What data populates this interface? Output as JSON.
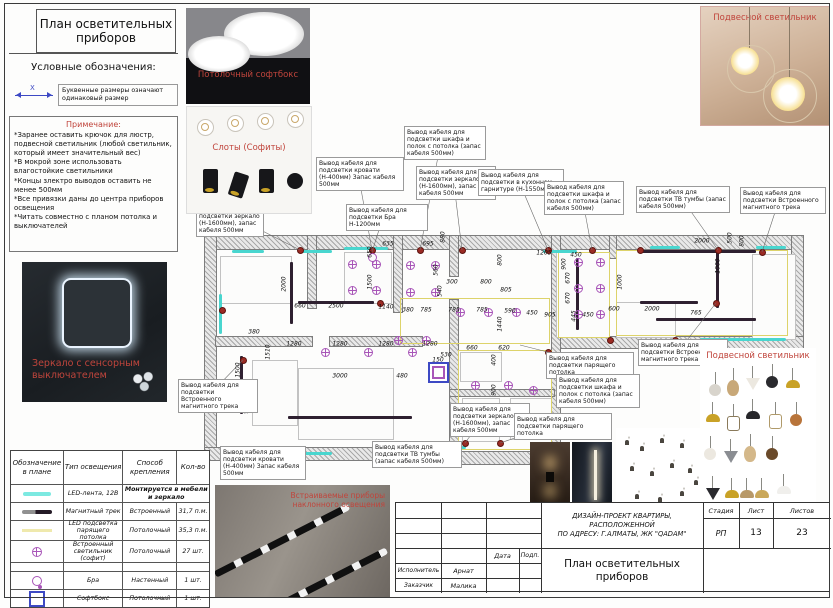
{
  "panel": {
    "title": "План осветительных приборов",
    "legend_header": "Условные обозначения:",
    "symbol_x": "X",
    "dim_note": "Буквенные размеры означают одинаковый размер",
    "notes_header": "Примечание:",
    "notes": [
      "*Заранее оставить крючок для люстр, подвесной светильник (любой светильник, который имеет значительный вес)",
      "*В мокрой зоне использовать влагостойкие светильники",
      "*Концы злектро выводов оставить не менее 500мм",
      "*Все привязки даны до центра приборов освещения",
      "*Читать совместно с планом потолка и выключателей"
    ],
    "mirror_caption": "Зеркало с сенсорным выключателем"
  },
  "photos": {
    "softbox_caption": "Потолочный софтбокс",
    "slots_caption": "Слоты (Софиты)",
    "pendant_top_caption": "Подвесной светильник",
    "pendant_collage_caption": "Подвесной светильник",
    "track_caption": "Встраиваемые приборы наклонного освещения"
  },
  "table": {
    "headers": [
      "Обозначение в плане",
      "Тип освещения",
      "Способ крепления",
      "Кол-во"
    ],
    "row_heights": [
      33,
      17,
      17,
      19,
      21,
      8,
      17,
      17
    ],
    "rows": [
      {
        "sym": "",
        "type": "",
        "mount": "",
        "qty": "",
        "header": true
      },
      {
        "sym": "led",
        "type": "LED-лента, 12В",
        "mount": "Монтируется в мебели и зеркало",
        "qty": "",
        "span": true
      },
      {
        "sym": "track",
        "type": "Магнитный трек",
        "mount": "Встроенный",
        "qty": "31,7 п.м."
      },
      {
        "sym": "ledceil",
        "type": "LED подсветка парящего потолка",
        "mount": "Потолочный",
        "qty": "35,3 п.м."
      },
      {
        "sym": "spot",
        "type": "Встроенный светильник (софит)",
        "mount": "Потолочный",
        "qty": "27 шт."
      },
      {
        "sym": "",
        "type": "",
        "mount": "",
        "qty": ""
      },
      {
        "sym": "bra",
        "type": "Бра",
        "mount": "Настенный",
        "qty": "1 шт."
      },
      {
        "sym": "softbox",
        "type": "Софтбокс",
        "mount": "Потолочный",
        "qty": "1 шт."
      }
    ]
  },
  "titleblock": {
    "project_lines": [
      "ДИЗАЙН-ПРОЕКТ КВАРТИРЫ,",
      "РАСПОЛОЖЕННОЙ",
      "ПО АДРЕСУ: Г.АЛМАТЫ, ЖК \"QADAM\""
    ],
    "sheet_title": "План осветительных приборов",
    "stage_label": "Стадия",
    "stage_value": "РП",
    "sheet_label": "Лист",
    "sheet_value": "13",
    "sheets_label": "Листов",
    "sheets_value": "23",
    "date_label": "Дата",
    "sign_label": "Подп.",
    "executor_label": "Исполнитель",
    "executor_value": "Арнат",
    "client_label": "Заказчик",
    "client_value": "Малика"
  },
  "plan": {
    "walls": [
      [
        205,
        236,
        598,
        13
      ],
      [
        792,
        236,
        11,
        110
      ],
      [
        556,
        337,
        247,
        11
      ],
      [
        205,
        236,
        11,
        224
      ],
      [
        205,
        448,
        236,
        12
      ],
      [
        440,
        452,
        122,
        12
      ],
      [
        216,
        337,
        96,
        9
      ],
      [
        330,
        337,
        92,
        9
      ],
      [
        308,
        236,
        8,
        72
      ],
      [
        394,
        236,
        8,
        76
      ],
      [
        450,
        236,
        8,
        40
      ],
      [
        450,
        300,
        8,
        152
      ],
      [
        552,
        236,
        8,
        216
      ],
      [
        610,
        236,
        6,
        22
      ],
      [
        450,
        390,
        104,
        6
      ]
    ],
    "furniture": [
      [
        220,
        256,
        70,
        46
      ],
      [
        344,
        252,
        46,
        50
      ],
      [
        252,
        360,
        44,
        64
      ],
      [
        298,
        368,
        94,
        70
      ],
      [
        460,
        352,
        40,
        28
      ],
      [
        462,
        398,
        36,
        42
      ],
      [
        510,
        398,
        40,
        40
      ],
      [
        556,
        252,
        52,
        84
      ],
      [
        752,
        254,
        42,
        84
      ],
      [
        616,
        302,
        58,
        34
      ]
    ],
    "yellow": [
      [
        400,
        298,
        148,
        44
      ],
      [
        558,
        252,
        50,
        84
      ],
      [
        616,
        250,
        170,
        84
      ],
      [
        458,
        350,
        92,
        98
      ]
    ],
    "cyan": [
      [
        232,
        250,
        32,
        3
      ],
      [
        298,
        250,
        34,
        3
      ],
      [
        344,
        247,
        44,
        3
      ],
      [
        543,
        250,
        34,
        3
      ],
      [
        650,
        246,
        30,
        3
      ],
      [
        282,
        452,
        50,
        3
      ],
      [
        420,
        446,
        46,
        3
      ],
      [
        700,
        338,
        86,
        3
      ],
      [
        219,
        294,
        3,
        40
      ],
      [
        756,
        246,
        30,
        3
      ]
    ],
    "tracks": [
      [
        290,
        262,
        3,
        62
      ],
      [
        298,
        301,
        76,
        3
      ],
      [
        240,
        356,
        3,
        58
      ],
      [
        288,
        416,
        124,
        3
      ],
      [
        576,
        258,
        3,
        72
      ],
      [
        640,
        250,
        116,
        3
      ],
      [
        716,
        252,
        3,
        56
      ],
      [
        640,
        301,
        58,
        3
      ],
      [
        656,
        318,
        100,
        3
      ]
    ],
    "spots": [
      [
        352,
        264
      ],
      [
        376,
        264
      ],
      [
        352,
        290
      ],
      [
        376,
        290
      ],
      [
        410,
        265
      ],
      [
        435,
        265
      ],
      [
        410,
        292
      ],
      [
        435,
        292
      ],
      [
        460,
        312
      ],
      [
        488,
        312
      ],
      [
        516,
        312
      ],
      [
        398,
        340
      ],
      [
        426,
        340
      ],
      [
        325,
        352
      ],
      [
        368,
        352
      ],
      [
        412,
        352
      ],
      [
        475,
        385
      ],
      [
        508,
        385
      ],
      [
        475,
        413
      ],
      [
        508,
        413
      ],
      [
        533,
        390
      ],
      [
        578,
        262
      ],
      [
        578,
        288
      ],
      [
        578,
        314
      ],
      [
        600,
        262
      ],
      [
        600,
        288
      ],
      [
        600,
        314
      ]
    ],
    "outlets": [
      [
        300,
        250
      ],
      [
        372,
        250
      ],
      [
        420,
        250
      ],
      [
        462,
        250
      ],
      [
        548,
        250
      ],
      [
        592,
        250
      ],
      [
        640,
        250
      ],
      [
        718,
        250
      ],
      [
        762,
        252
      ],
      [
        302,
        454
      ],
      [
        425,
        448
      ],
      [
        465,
        443
      ],
      [
        500,
        443
      ],
      [
        548,
        352
      ],
      [
        610,
        340
      ],
      [
        675,
        340
      ],
      [
        222,
        310
      ],
      [
        243,
        360
      ],
      [
        380,
        303
      ],
      [
        716,
        303
      ]
    ],
    "bra_symbol": [
      372,
      257
    ],
    "softbox_symbol": [
      428,
      362,
      17,
      17
    ],
    "dims": [
      [
        "1400",
        358,
        227,
        0
      ],
      [
        "880",
        443,
        237,
        1
      ],
      [
        "635",
        388,
        244,
        0
      ],
      [
        "695",
        428,
        244,
        0
      ],
      [
        "650",
        370,
        252,
        1
      ],
      [
        "2000",
        284,
        284,
        1
      ],
      [
        "1500",
        370,
        282,
        1
      ],
      [
        "560",
        436,
        270,
        1
      ],
      [
        "540",
        440,
        291,
        1
      ],
      [
        "300",
        452,
        282,
        0
      ],
      [
        "800",
        486,
        282,
        0
      ],
      [
        "805",
        506,
        290,
        0
      ],
      [
        "800",
        500,
        260,
        1
      ],
      [
        "1205",
        544,
        253,
        0
      ],
      [
        "900",
        564,
        264,
        1
      ],
      [
        "450",
        576,
        255,
        0
      ],
      [
        "670",
        568,
        278,
        1
      ],
      [
        "670",
        568,
        298,
        1
      ],
      [
        "445",
        574,
        316,
        1
      ],
      [
        "905",
        550,
        315,
        0
      ],
      [
        "450",
        532,
        313,
        0
      ],
      [
        "450",
        588,
        315,
        0
      ],
      [
        "600",
        614,
        309,
        0
      ],
      [
        "2000",
        652,
        309,
        0
      ],
      [
        "765",
        696,
        313,
        0
      ],
      [
        "1000",
        620,
        282,
        1
      ],
      [
        "2000",
        702,
        241,
        0
      ],
      [
        "800",
        742,
        241,
        1
      ],
      [
        "500",
        730,
        238,
        1
      ],
      [
        "1000",
        718,
        266,
        1
      ],
      [
        "660",
        300,
        306,
        0
      ],
      [
        "2500",
        336,
        306,
        0
      ],
      [
        "1140",
        386,
        307,
        0
      ],
      [
        "380",
        408,
        310,
        0
      ],
      [
        "785",
        426,
        310,
        0
      ],
      [
        "785",
        454,
        310,
        0
      ],
      [
        "785",
        482,
        310,
        0
      ],
      [
        "590",
        510,
        311,
        0
      ],
      [
        "1440",
        500,
        324,
        1
      ],
      [
        "1280",
        294,
        344,
        0
      ],
      [
        "1280",
        340,
        344,
        0
      ],
      [
        "1280",
        386,
        344,
        0
      ],
      [
        "1280",
        430,
        344,
        0
      ],
      [
        "1510",
        268,
        352,
        1
      ],
      [
        "380",
        254,
        332,
        0
      ],
      [
        "1500",
        238,
        370,
        1
      ],
      [
        "3000",
        340,
        376,
        0
      ],
      [
        "480",
        402,
        376,
        0
      ],
      [
        "900",
        246,
        408,
        1
      ],
      [
        "150",
        438,
        360,
        0
      ],
      [
        "530",
        446,
        355,
        0
      ],
      [
        "660",
        472,
        348,
        0
      ],
      [
        "620",
        504,
        348,
        0
      ],
      [
        "400",
        494,
        360,
        1
      ],
      [
        "900",
        494,
        390,
        1
      ]
    ],
    "callouts": [
      {
        "t": "Вывод кабеля для подсветки зеркало (Н-1600мм), запас кабеля 500мм",
        "x": 196,
        "y": 203,
        "w": 62,
        "lx": 300,
        "ly": 250
      },
      {
        "t": "Вывод кабеля для подсветки кровати (Н-400мм) Запас кабеля 500мм",
        "x": 316,
        "y": 157,
        "w": 82,
        "lx": 372,
        "ly": 250
      },
      {
        "t": "Вывод кабеля для подсветки Бра Н-1200мм",
        "x": 346,
        "y": 204,
        "w": 76,
        "lx": 372,
        "ly": 252
      },
      {
        "t": "Вывод кабеля для подсветки шкафа и полок с потолка (запас кабеля 500мм)",
        "x": 404,
        "y": 126,
        "w": 76,
        "lx": 420,
        "ly": 250
      },
      {
        "t": "Вывод кабеля для подсветки зеркало (Н-1600мм), запас кабеля 500мм",
        "x": 416,
        "y": 166,
        "w": 74,
        "lx": 462,
        "ly": 250
      },
      {
        "t": "Вывод кабеля для подсветки в кухонном гарнитуре (Н-1550мм)",
        "x": 478,
        "y": 169,
        "w": 80,
        "lx": 548,
        "ly": 250
      },
      {
        "t": "Вывод кабеля для подсветки шкафа и полок с потолка (запас кабеля 500мм)",
        "x": 544,
        "y": 181,
        "w": 74,
        "lx": 592,
        "ly": 250
      },
      {
        "t": "Вывод кабеля для подсветки ТВ тумбы (запас кабеля 500мм)",
        "x": 636,
        "y": 186,
        "w": 88,
        "lx": 718,
        "ly": 250
      },
      {
        "t": "Вывод кабеля для подсветки Встроенного магнитного трека",
        "x": 740,
        "y": 187,
        "w": 80,
        "lx": 762,
        "ly": 252
      },
      {
        "t": "Вывод кабеля для подсветки Встроенного магнитного трека",
        "x": 178,
        "y": 379,
        "w": 74,
        "lx": 243,
        "ly": 360
      },
      {
        "t": "Вывод кабеля для подсветки кровати (Н-400мм) Запас кабеля 500мм",
        "x": 220,
        "y": 446,
        "w": 80,
        "lx": 302,
        "ly": 454
      },
      {
        "t": "Вывод кабеля для подсветки ТВ тумбы (запас кабеля 500мм)",
        "x": 372,
        "y": 441,
        "w": 84,
        "lx": 425,
        "ly": 448
      },
      {
        "t": "Вывод кабеля для подсветки зеркало (Н-1600мм), запас кабеля 500мм",
        "x": 450,
        "y": 403,
        "w": 74,
        "lx": 465,
        "ly": 443
      },
      {
        "t": "Вывод кабеля для подсветки парящего потолка",
        "x": 514,
        "y": 413,
        "w": 92,
        "lx": 500,
        "ly": 443
      },
      {
        "t": "Вывод кабеля для подсветки парящего потолка",
        "x": 546,
        "y": 352,
        "w": 82,
        "lx": 520,
        "ly": 345
      },
      {
        "t": "Вывод кабеля для подсветки шкафа и полок с потолка (запас кабеля 500мм)",
        "x": 556,
        "y": 374,
        "w": 78,
        "lx": 548,
        "ly": 352
      },
      {
        "t": "Вывод кабеля для подсветки Встроенного магнитного трека",
        "x": 638,
        "y": 339,
        "w": 84,
        "lx": 716,
        "ly": 303
      }
    ]
  },
  "collage": {
    "lamps": [
      [
        715,
        388,
        "ball",
        "#d8d4cc"
      ],
      [
        733,
        384,
        "egg",
        "#c8a878"
      ],
      [
        752,
        382,
        "cone",
        "#ece8e0"
      ],
      [
        772,
        380,
        "ball",
        "#2a2a2e"
      ],
      [
        792,
        384,
        "dome",
        "#c9a227"
      ],
      [
        712,
        418,
        "dome",
        "#c9a227"
      ],
      [
        733,
        420,
        "lantern",
        "#8a7a5a"
      ],
      [
        752,
        415,
        "dome",
        "#26262a"
      ],
      [
        775,
        418,
        "lantern",
        "#b09a6a"
      ],
      [
        796,
        418,
        "ball",
        "#b8743a"
      ],
      [
        710,
        452,
        "ball",
        "#ece8e0"
      ],
      [
        730,
        455,
        "cone",
        "#8a8d92"
      ],
      [
        750,
        450,
        "egg",
        "#d4b88a"
      ],
      [
        772,
        452,
        "ball",
        "#6a4a2a"
      ],
      [
        712,
        492,
        "cone",
        "#2a2a2e"
      ],
      [
        731,
        494,
        "dome",
        "#c9a227"
      ],
      [
        746,
        494,
        "dome",
        "#b89968"
      ],
      [
        761,
        494,
        "dome",
        "#caa85a"
      ],
      [
        783,
        490,
        "dome",
        "#f0efec"
      ]
    ],
    "minis": [
      [
        625,
        440
      ],
      [
        640,
        446
      ],
      [
        660,
        438
      ],
      [
        680,
        443
      ],
      [
        630,
        466
      ],
      [
        650,
        471
      ],
      [
        670,
        463
      ],
      [
        688,
        468
      ],
      [
        635,
        494
      ],
      [
        658,
        497
      ],
      [
        680,
        491
      ],
      [
        694,
        480
      ]
    ]
  },
  "colors": {
    "accent_red": "#c0453c",
    "spot_magenta": "#a855b8",
    "track_dark": "#2e2030",
    "led_cyan": "#49d6cf",
    "led_yellow": "#ddd36a",
    "outlet_red": "#9c2b24",
    "symbol_blue": "#3d49c4"
  }
}
